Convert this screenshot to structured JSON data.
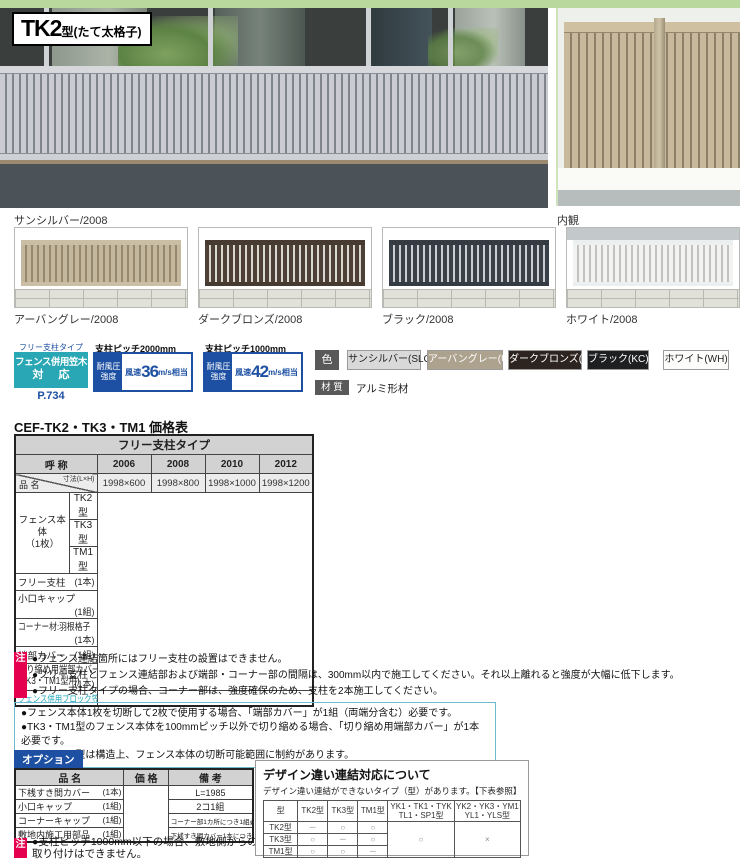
{
  "theme": {
    "accent_green": "#b9d89e",
    "teal": "#2aa7b4",
    "blue": "#1d50a2",
    "magenta": "#e4004f"
  },
  "header": {
    "model": "TK2",
    "type_label": "型(たて太格子)"
  },
  "captions": {
    "main": "サンシルバー/2008",
    "interior": "内観"
  },
  "variants": [
    {
      "caption": "アーバングレー/2008"
    },
    {
      "caption": "ダークブロンズ/2008"
    },
    {
      "caption": "ブラック/2008"
    },
    {
      "caption": "ホワイト/2008"
    }
  ],
  "spec": {
    "free_post_type": "フリー支柱タイプ",
    "kasagi": {
      "line1": "フェンス併用笠木",
      "line2": "対 応",
      "page_ref": "P.734"
    },
    "wind": [
      {
        "pitch": "支柱ピッチ2000mm",
        "label1": "耐風圧",
        "label2": "強度",
        "prefix": "風速",
        "value": "36",
        "suffix": "m/s相当"
      },
      {
        "pitch": "支柱ピッチ1000mm",
        "label1": "耐風圧",
        "label2": "強度",
        "prefix": "風速",
        "value": "42",
        "suffix": "m/s相当"
      }
    ],
    "color_label": "色",
    "colors": [
      {
        "name": "サンシルバー(SLC)",
        "bg": "#d9d9d9",
        "fg": "#222222"
      },
      {
        "name": "アーバングレー(UC)",
        "bg": "#ada28e",
        "fg": "#ffffff"
      },
      {
        "name": "ダークブロンズ(BD)",
        "bg": "#2d2420",
        "fg": "#ffffff"
      },
      {
        "name": "ブラック(KC)",
        "bg": "#1d1f21",
        "fg": "#ffffff"
      },
      {
        "name": "ホワイト(WH)",
        "bg": "#fdfdfc",
        "fg": "#222222"
      }
    ],
    "material_label": "材 質",
    "material_value": "アルミ形材"
  },
  "price_table": {
    "title": "CEF-TK2・TK3・TM1 価格表",
    "type_header": "フリー支柱タイプ",
    "name_header": "呼 称",
    "item_header": "品 名",
    "size_header": "寸法(L×H)",
    "columns": [
      "2006",
      "2008",
      "2010",
      "2012"
    ],
    "sizes": [
      "1998×600",
      "1998×800",
      "1998×1000",
      "1998×1200"
    ],
    "body_label": "フェンス本体",
    "body_unit": "（1枚）",
    "body_types": [
      "TK2型",
      "TK3型",
      "TM1型"
    ],
    "items": [
      {
        "name": "フリー支柱",
        "unit": "(1本)"
      },
      {
        "name": "小口キャップ",
        "unit": "(1組)"
      },
      {
        "name": "コーナー材:羽根格子",
        "unit": "(1本)"
      },
      {
        "name": "端部カバー",
        "unit": "(1組)"
      }
    ],
    "tall_item": {
      "name": "切り縮め用端部カバー",
      "name2": "(TK3・TM1型用)",
      "unit": "(1本)"
    },
    "footer_item": "フェンス併用ブロック笠木"
  },
  "notes_primary": {
    "badge": "注",
    "items": [
      "●フェンス連結箇所にはフリー支柱の設置はできません。",
      "●フリー支柱とフェンス連結部および端部・コーナー部の間隔は、300mm以内で施工してください。それ以上離れると強度が大幅に低下します。",
      "●フリー支柱タイプの場合、コーナー部は、強度確保のため、支柱を2本施工してください。"
    ]
  },
  "notes_secondary": {
    "items": [
      "●フェンス本体1枚を切断して2枚で使用する場合、「端部カバー」が1組（両端分含む）必要です。",
      "●TK3・TM1型のフェンス本体を100mmピッチ以外で切り縮める場合、「切り縮め用端部カバー」が1本必要です。",
      "●TK3・TM1型は構造上、フェンス本体の切断可能範囲に制約があります。"
    ]
  },
  "options": {
    "label": "オプション",
    "headers": [
      "品 名",
      "価 格",
      "備 考"
    ],
    "rows": [
      {
        "name": "下桟すき間カバー",
        "unit": "(1本)",
        "remark": "L=1985"
      },
      {
        "name": "小口キャップ",
        "unit": "(1組)",
        "remark": "2コ1組"
      },
      {
        "name": "コーナーキャップ",
        "unit": "(1組)",
        "remark": "コーナー部1カ所につき1組必要"
      },
      {
        "name": "敷地内施工用部品",
        "unit": "(1組)",
        "remark": "下桟すき間カバー1本につき1組必要"
      }
    ],
    "note_badge": "注",
    "note_line1": "●支柱ピッチ1000mm以下の場合、敷地側からの",
    "note_line2": "取り付けはできません。"
  },
  "design_panel": {
    "title": "デザイン違い連結対応について",
    "subtitle": "デザイン違い連結ができないタイプ（型）があります。【下表参照】",
    "corner": "型",
    "columns": [
      "TK2型",
      "TK3型",
      "TM1型"
    ],
    "wide_columns": [
      {
        "line1": "YK1・TK1・TYK",
        "line2": "TL1・SP1型"
      },
      {
        "line1": "YK2・YK3・YM1",
        "line2": "YL1・YLS型"
      }
    ],
    "rows": [
      {
        "label": "TK2型",
        "c0": "－",
        "c1": "○",
        "c2": "○"
      },
      {
        "label": "TK3型",
        "c0": "○",
        "c1": "－",
        "c2": "○"
      },
      {
        "label": "TM1型",
        "c0": "○",
        "c1": "○",
        "c2": "－"
      }
    ],
    "merged": {
      "wide1": "○",
      "wide2": "×"
    }
  }
}
